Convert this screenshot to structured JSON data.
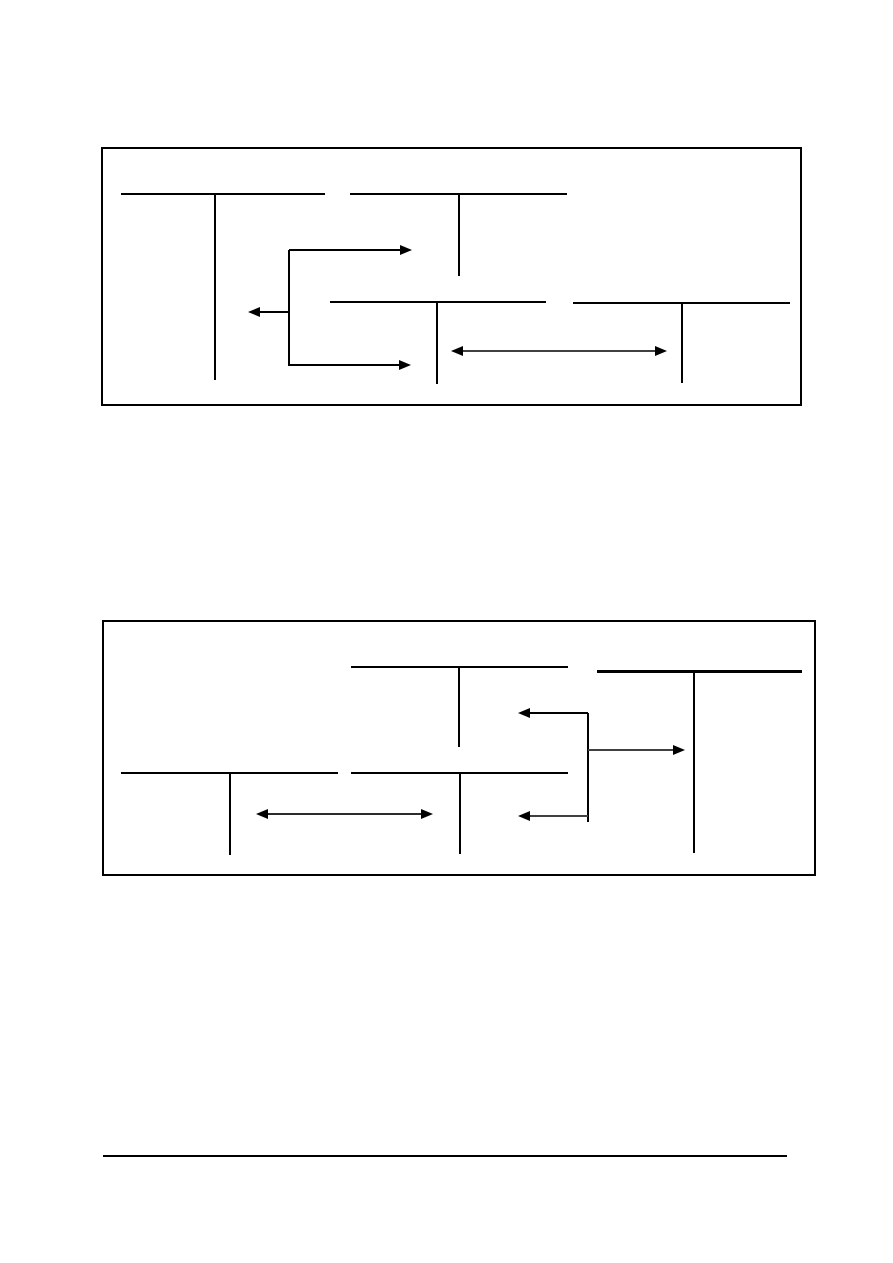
{
  "page": {
    "background": "#ffffff",
    "width": 893,
    "height": 1263
  },
  "style": {
    "line_color": "#000000",
    "gray_line_color": "#404040",
    "head_color": "#000000",
    "arrow_head": {
      "length": 12,
      "half_height": 5
    }
  },
  "figures": [
    {
      "name": "t-account-flow-diagram-top",
      "frame": {
        "x": 101,
        "y": 147,
        "width": 701,
        "height": 259,
        "border_color": "#000000",
        "border_width": 2
      },
      "t_accounts": [
        {
          "name": "account-top-left",
          "bar": {
            "x1": 18,
            "x2": 222,
            "y": 45,
            "thickness": 1.5
          },
          "stem": {
            "x": 112,
            "y1": 45,
            "y2": 231,
            "thickness": 1.5
          }
        },
        {
          "name": "account-top-middle",
          "bar": {
            "x1": 247,
            "x2": 464,
            "y": 45,
            "thickness": 1.5
          },
          "stem": {
            "x": 356,
            "y1": 45,
            "y2": 127,
            "thickness": 1.5
          }
        },
        {
          "name": "account-bottom-middle",
          "bar": {
            "x1": 227,
            "x2": 443,
            "y": 153,
            "thickness": 1.5
          },
          "stem": {
            "x": 334,
            "y1": 153,
            "y2": 235,
            "thickness": 1.5
          }
        },
        {
          "name": "account-bottom-right",
          "bar": {
            "x1": 470,
            "x2": 687,
            "y": 154,
            "thickness": 1.5
          },
          "stem": {
            "x": 579,
            "y1": 154,
            "y2": 234,
            "thickness": 1.5
          }
        }
      ],
      "connectors": [
        {
          "name": "branch-connector",
          "x": 186,
          "y1": 101,
          "y2": 217,
          "thickness": 1.5
        }
      ],
      "arrows": [
        {
          "name": "arrow-upper-right",
          "x1": 186,
          "x2": 309,
          "y": 101,
          "head_left": false,
          "head_right": true,
          "shaft_color": "#000000",
          "thickness": 1.5
        },
        {
          "name": "arrow-left",
          "x1": 145,
          "x2": 186,
          "y": 163,
          "head_left": true,
          "head_right": false,
          "shaft_color": "#000000",
          "thickness": 1.5
        },
        {
          "name": "arrow-lower-right",
          "x1": 186,
          "x2": 308,
          "y": 216,
          "head_left": false,
          "head_right": true,
          "shaft_color": "#000000",
          "thickness": 1.5
        },
        {
          "name": "double-arrow",
          "x1": 348,
          "x2": 564,
          "y": 202,
          "head_left": true,
          "head_right": true,
          "shaft_color": "#404040",
          "thickness": 2.5
        }
      ]
    },
    {
      "name": "t-account-flow-diagram-bottom",
      "frame": {
        "x": 102,
        "y": 620,
        "width": 714,
        "height": 256,
        "border_color": "#000000",
        "border_width": 2
      },
      "t_accounts": [
        {
          "name": "account-top-middle",
          "bar": {
            "x1": 247,
            "x2": 464,
            "y": 45,
            "thickness": 1.5
          },
          "stem": {
            "x": 355,
            "y1": 45,
            "y2": 125,
            "thickness": 1.5
          }
        },
        {
          "name": "account-top-right",
          "bar": {
            "x1": 493,
            "x2": 698,
            "y": 49,
            "thickness": 3
          },
          "stem": {
            "x": 590,
            "y1": 49,
            "y2": 231,
            "thickness": 1.5
          }
        },
        {
          "name": "account-bottom-left",
          "bar": {
            "x1": 17,
            "x2": 234,
            "y": 151,
            "thickness": 1.5
          },
          "stem": {
            "x": 126,
            "y1": 151,
            "y2": 233,
            "thickness": 1.5
          }
        },
        {
          "name": "account-bottom-middle",
          "bar": {
            "x1": 247,
            "x2": 464,
            "y": 151,
            "thickness": 1.5
          },
          "stem": {
            "x": 356,
            "y1": 151,
            "y2": 232,
            "thickness": 1.5
          }
        }
      ],
      "connectors": [
        {
          "name": "branch-connector",
          "x": 484,
          "y1": 91,
          "y2": 200,
          "thickness": 1.5
        }
      ],
      "arrows": [
        {
          "name": "arrow-upper-left",
          "x1": 414,
          "x2": 484,
          "y": 91,
          "head_left": true,
          "head_right": false,
          "shaft_color": "#000000",
          "thickness": 1.5
        },
        {
          "name": "arrow-right",
          "x1": 484,
          "x2": 581,
          "y": 128,
          "head_left": false,
          "head_right": true,
          "shaft_color": "#404040",
          "thickness": 2.5
        },
        {
          "name": "arrow-lower-left",
          "x1": 414,
          "x2": 484,
          "y": 194,
          "head_left": true,
          "head_right": false,
          "shaft_color": "#404040",
          "thickness": 2.5
        },
        {
          "name": "double-arrow",
          "x1": 152,
          "x2": 329,
          "y": 192,
          "head_left": true,
          "head_right": true,
          "shaft_color": "#2b2b2b",
          "thickness": 2
        }
      ]
    }
  ],
  "footer_rule": {
    "x": 103,
    "y": 1155,
    "width": 684,
    "thickness": 2,
    "color": "#000000"
  }
}
